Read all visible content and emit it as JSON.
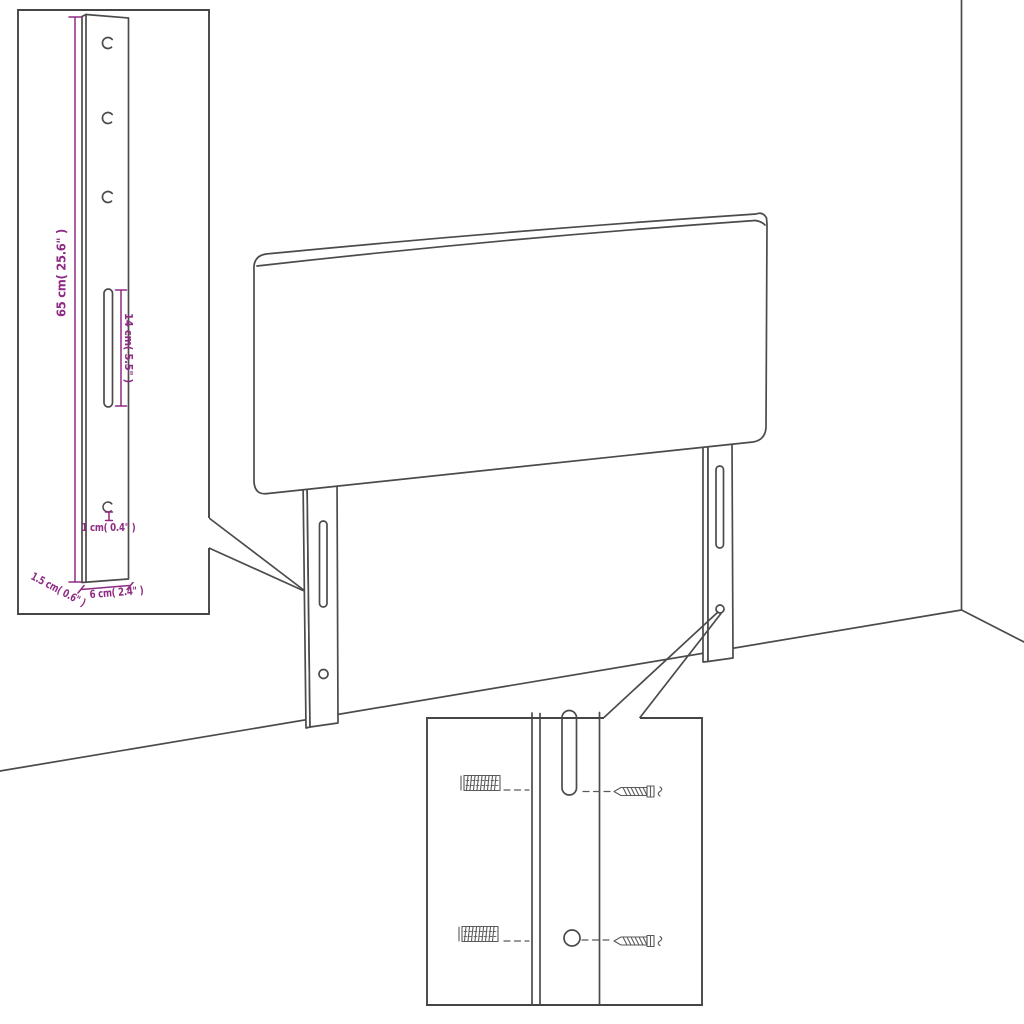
{
  "colors": {
    "line": "#4b4b4b",
    "dimension": "#8e2b84",
    "background": "#ffffff"
  },
  "bracket_inset": {
    "dim_height": "65 cm( 25.6\" )",
    "dim_slot_length": "14 cm( 5.5\" )",
    "dim_hole_diameter": "1 cm( 0.4\" )",
    "dim_thickness": "1.5 cm( 0.6\" )",
    "dim_width": "6 cm( 2.4\" )"
  }
}
